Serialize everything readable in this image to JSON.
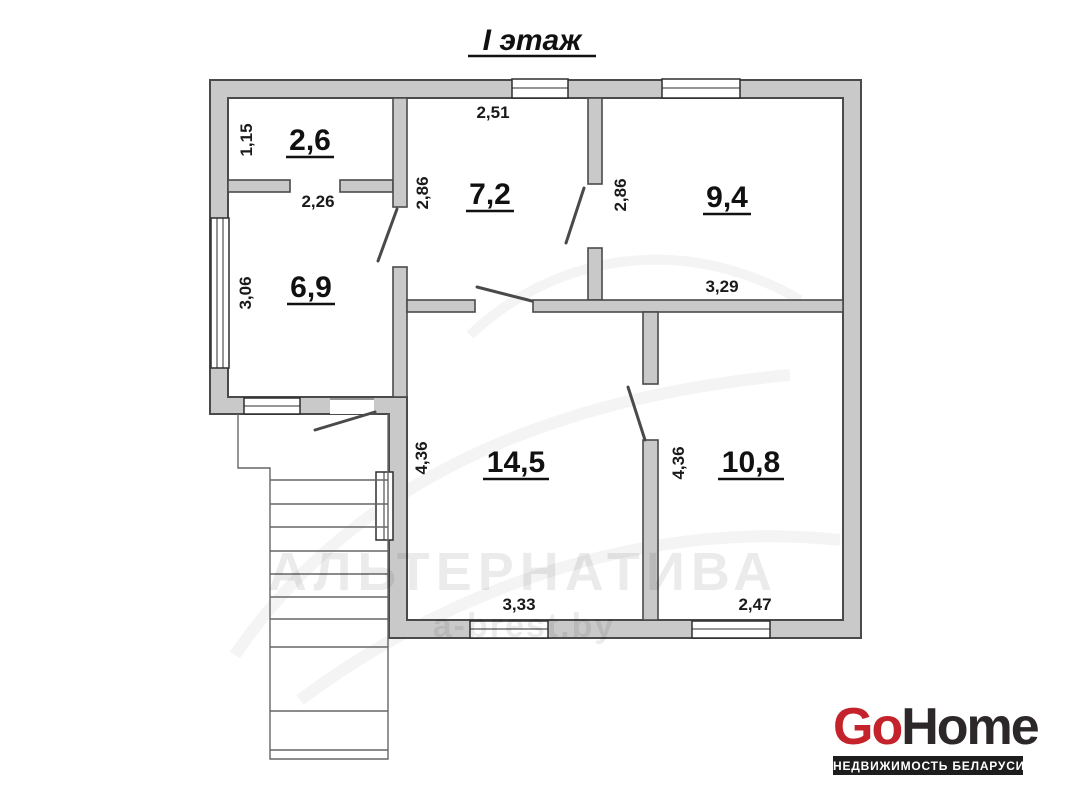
{
  "floor_title": "I этаж",
  "rooms": [
    {
      "area_label": "2,6",
      "height_label": "1,15"
    },
    {
      "area_label": "6,9",
      "width_label": "2,26",
      "height_label": "3,06"
    },
    {
      "area_label": "7,2",
      "width_label": "2,51",
      "height_label": "2,86"
    },
    {
      "area_label": "9,4",
      "width_label": "3,29",
      "height_label": "2,86"
    },
    {
      "area_label": "14,5",
      "width_label": "3,33",
      "height_label": "4,36"
    },
    {
      "area_label": "10,8",
      "width_label": "2,47",
      "height_label": "4,36"
    }
  ],
  "watermark": {
    "line1": "АЛЬТЕРНАТИВА",
    "line2": "a-brest.by"
  },
  "logo": {
    "go": "Go",
    "home": "Home",
    "tagline": "НЕДВИЖИМОСТЬ БЕЛАРУСИ"
  },
  "colors": {
    "wall_fill": "#c9c9c9",
    "wall_line": "#4a4a4a",
    "label_text": "#111111",
    "logo_red": "#c4232b",
    "logo_dark": "#2c2829",
    "tagline_bg": "#1d1d1d"
  }
}
